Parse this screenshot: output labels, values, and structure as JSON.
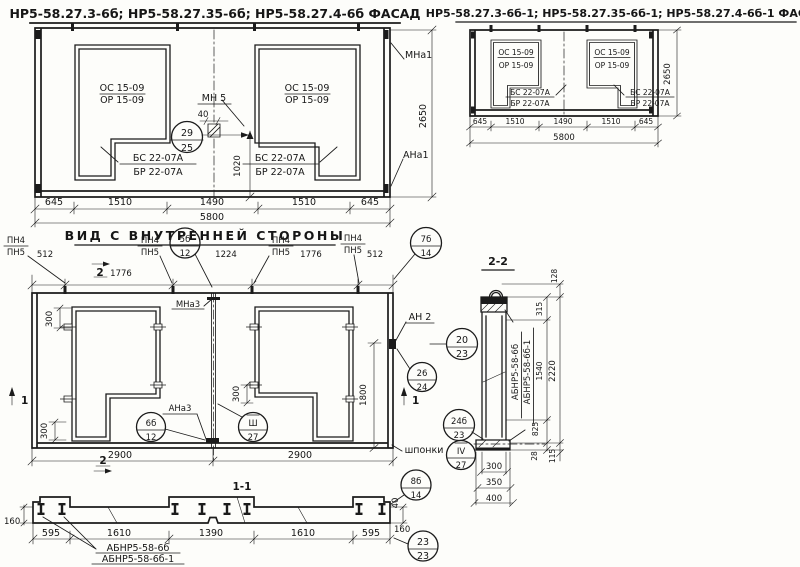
{
  "facade_left": {
    "title": "НР5-58.27.3-6б; НР5-58.27.35-6б; НР5-58.27.4-6б ФАСАД",
    "window_mark_top": "ОС 15-09",
    "window_mark_bottom": "ОР 15-09",
    "niche_mark_top": "БС 22-07А",
    "niche_mark_bottom": "БР 22-07А",
    "embed_label": "МН 5",
    "embed_size": "40",
    "dim_vert_center": "1020",
    "anchor_top_right": "МНа1",
    "anchor_bottom_right": "АНа1",
    "dim_height": "2650",
    "dims_bottom": [
      "645",
      "1510",
      "1490",
      "1510",
      "645"
    ],
    "dim_total": "5800"
  },
  "facade_right": {
    "title": "НР5-58.27.3-6б-1; НР5-58.27.35-6б-1; НР5-58.27.4-6б-1 ФАСАД",
    "window_mark_top": "ОС 15-09",
    "window_mark_bottom": "ОР 15-09",
    "niche_mark_top": "БС 22-07А",
    "niche_mark_bottom": "БР 22-07А",
    "dim_height": "2650",
    "dims_bottom": [
      "645",
      "1510",
      "1490",
      "1510",
      "645"
    ],
    "dim_total": "5800"
  },
  "inner_view": {
    "title": "ВИД С ВНУТРЕННЕЙ СТОРОНЫ",
    "pn_top": "ПН4",
    "pn_bottom": "ПН5",
    "dims_top": [
      "512",
      "1776",
      "1224",
      "1776",
      "512"
    ],
    "section_marker_1": "1",
    "section_marker_2": "2",
    "mna3": "МНа3",
    "ana3": "АНа3",
    "an2": "АН 2",
    "dim_300": "300",
    "dim_1800": "1800",
    "dims_bottom": [
      "2900",
      "2900"
    ],
    "shponki_label": "шпонки"
  },
  "section_1_1": {
    "title": "1-1",
    "dim_160": "160",
    "dim_40": "40",
    "dims_bottom": [
      "595",
      "1610",
      "1390",
      "1610",
      "595"
    ],
    "block_label_1": "АБНР5-58-6б",
    "block_label_2": "АБНР5-58-6б-1"
  },
  "section_2_2": {
    "title": "2-2",
    "block_label_1": "АБНР5-58-6б",
    "block_label_2": "АБНР5-58-6б-1",
    "dim_128": "128",
    "dim_315": "315",
    "dim_2220": "2220",
    "dim_1540": "1540",
    "dim_825": "825",
    "dim_28": "28",
    "dim_115": "115",
    "dim_300": "300",
    "dim_350": "350",
    "dim_400": "400"
  },
  "callouts": {
    "c29_25": {
      "top": "29",
      "bottom": "25"
    },
    "c5b_12": {
      "top": "5б",
      "bottom": "12"
    },
    "c7b_14": {
      "top": "7б",
      "bottom": "14"
    },
    "c6b_12": {
      "top": "6б",
      "bottom": "12"
    },
    "c3_27": {
      "top": "Ш",
      "bottom": "27"
    },
    "c20_23": {
      "top": "20",
      "bottom": "23"
    },
    "c26_24": {
      "top": "26",
      "bottom": "24"
    },
    "c24b_23": {
      "top": "24б",
      "bottom": "23"
    },
    "c4_27": {
      "top": "IV",
      "bottom": "27"
    },
    "c8b_14": {
      "top": "8б",
      "bottom": "14"
    },
    "c23_23": {
      "top": "23",
      "bottom": "23"
    }
  }
}
